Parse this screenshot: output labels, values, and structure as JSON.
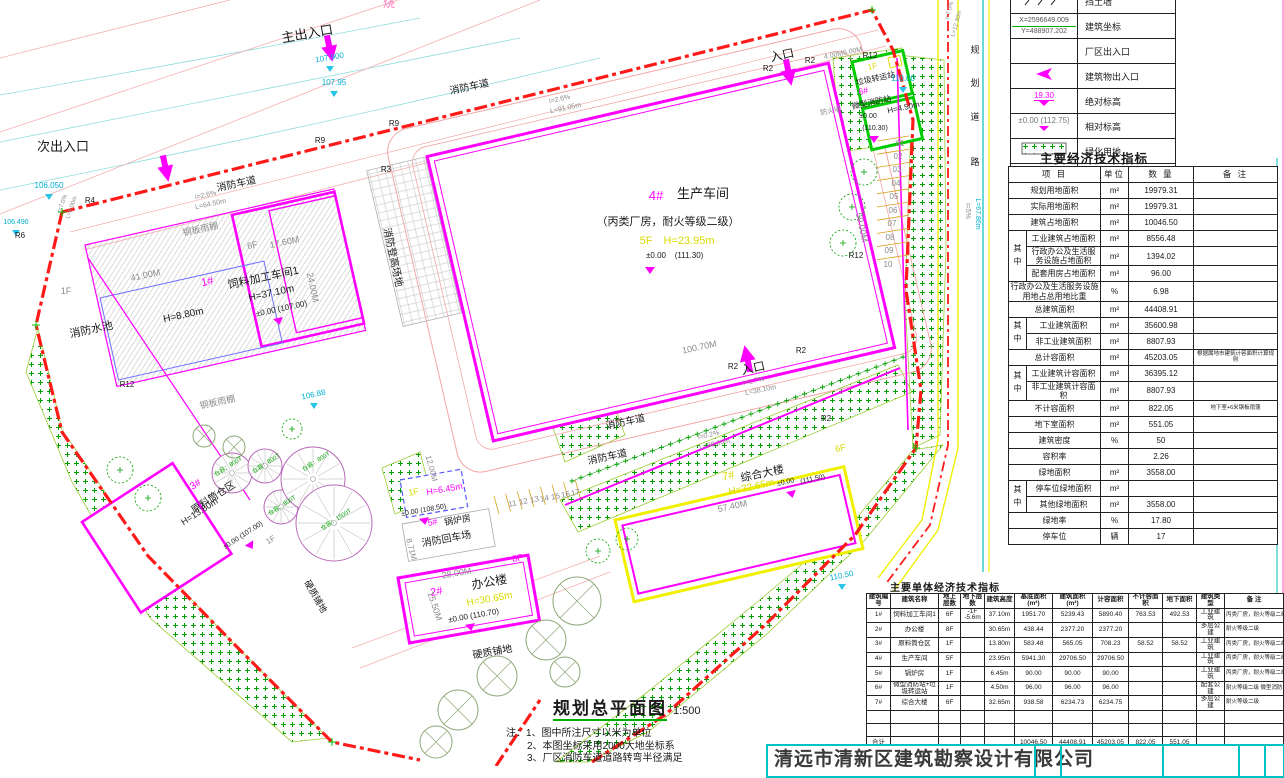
{
  "sheet": {
    "drawing_title": "规划总平面图",
    "scale": "1:500",
    "company": "清远市清新区建筑勘察设计有限公司"
  },
  "notes": {
    "prefix": "注：",
    "lines": [
      "1、图中所注尺寸以米为单位",
      "2、本图坐标采用2000大地坐标系",
      "3、厂区消防车道道路转弯半径满足"
    ]
  },
  "legend": {
    "rows": [
      {
        "sym": "retaining-wall",
        "label": "挡土墙",
        "texts": []
      },
      {
        "sym": "coords",
        "label": "建筑坐标",
        "texts": [
          "X=2596649.009",
          "Y=488907.202"
        ]
      },
      {
        "sym": "blank",
        "label": "厂区出入口",
        "texts": []
      },
      {
        "sym": "entry-arrow",
        "label": "建筑物出入口",
        "texts": []
      },
      {
        "sym": "abs-elev",
        "label": "绝对标高",
        "texts": [
          "19.30"
        ]
      },
      {
        "sym": "rel-elev",
        "label": "相对标高",
        "texts": [
          "±0.00 (112.75)"
        ]
      },
      {
        "sym": "green-hatch",
        "label": "绿化用地",
        "texts": []
      },
      {
        "sym": "road",
        "label": "厂区道路（消防车道）",
        "texts": []
      }
    ]
  },
  "tables": {
    "main": {
      "title": "主要经济技术指标",
      "headers": [
        "项  目",
        "单位",
        "数  量",
        "备  注"
      ],
      "rows": [
        {
          "item": "规划用地面积",
          "unit": "m²",
          "qty": "19979.31",
          "rem": ""
        },
        {
          "item": "实际用地面积",
          "unit": "m²",
          "qty": "19979.31",
          "rem": ""
        },
        {
          "item": "建筑占地面积",
          "unit": "m²",
          "qty": "10046.50",
          "rem": ""
        },
        {
          "g": "其中",
          "span": 3,
          "item": "工业建筑占地面积",
          "unit": "m²",
          "qty": "8556.48",
          "rem": ""
        },
        {
          "item": "行政办公及生活服务设施占地面积",
          "unit": "m²",
          "qty": "1394.02",
          "rem": ""
        },
        {
          "item": "配套用房占地面积",
          "unit": "m²",
          "qty": "96.00",
          "rem": ""
        },
        {
          "item": "行政办公及生活服务设施用地占总用地比重",
          "unit": "%",
          "qty": "6.98",
          "rem": ""
        },
        {
          "item": "总建筑面积",
          "unit": "m²",
          "qty": "44408.91",
          "rem": ""
        },
        {
          "g": "其中",
          "span": 2,
          "item": "工业建筑面积",
          "unit": "m²",
          "qty": "35600.98",
          "rem": ""
        },
        {
          "item": "非工业建筑面积",
          "unit": "m²",
          "qty": "8807.93",
          "rem": ""
        },
        {
          "item": "总计容面积",
          "unit": "m²",
          "qty": "45203.05",
          "rem": "根据属地市建筑计容面积计算规则"
        },
        {
          "g": "其中",
          "span": 2,
          "item": "工业建筑计容面积",
          "unit": "m²",
          "qty": "36395.12",
          "rem": ""
        },
        {
          "item": "非工业建筑计容面积",
          "unit": "m²",
          "qty": "8807.93",
          "rem": ""
        },
        {
          "item": "不计容面积",
          "unit": "m²",
          "qty": "822.05",
          "rem": "地下室+6米钢板雨篷"
        },
        {
          "item": "地下室面积",
          "unit": "m²",
          "qty": "551.05",
          "rem": ""
        },
        {
          "item": "建筑密度",
          "unit": "%",
          "qty": "50",
          "rem": ""
        },
        {
          "item": "容积率",
          "unit": "",
          "qty": "2.26",
          "rem": ""
        },
        {
          "item": "绿地面积",
          "unit": "m²",
          "qty": "3558.00",
          "rem": ""
        },
        {
          "g": "其中",
          "span": 2,
          "item": "停车位绿地面积",
          "unit": "m²",
          "qty": "",
          "rem": ""
        },
        {
          "item": "其他绿地面积",
          "unit": "m²",
          "qty": "3558.00",
          "rem": ""
        },
        {
          "item": "绿地率",
          "unit": "%",
          "qty": "17.80",
          "rem": ""
        },
        {
          "item": "停车位",
          "unit": "辆",
          "qty": "17",
          "rem": ""
        }
      ]
    },
    "unit": {
      "title": "主要单体经济技术指标",
      "headers": [
        "建筑编号",
        "建筑名称",
        "地上层数",
        "地下层数",
        "建筑高度",
        "基底面积(m²)",
        "建筑面积(m²)",
        "计容面积",
        "不计容面积",
        "地下面积",
        "建筑类型",
        "备  注"
      ],
      "rows": [
        [
          "1#",
          "饲料加工车间1",
          "6F",
          "-1F -5.6m",
          "37.10m",
          "1951.70",
          "5239.43",
          "5890.40",
          "763.53",
          "492.53",
          "工业建筑",
          "丙类厂房，耐火等级二级"
        ],
        [
          "2#",
          "办公楼",
          "8F",
          "",
          "30.65m",
          "438.44",
          "2377.20",
          "2377.20",
          "",
          "",
          "多层公建",
          "耐火等级二级"
        ],
        [
          "3#",
          "原料筒仓区",
          "1F",
          "",
          "13.80m",
          "583.48",
          "565.05",
          "708.23",
          "58.52",
          "58.52",
          "工业建筑",
          "丙类厂房，耐火等级二级"
        ],
        [
          "4#",
          "生产车间",
          "5F",
          "",
          "23.95m",
          "5941.30",
          "29706.50",
          "29706.50",
          "",
          "",
          "工业建筑",
          "丙类厂房，耐火等级二级"
        ],
        [
          "5#",
          "锅炉房",
          "1F",
          "",
          "6.45m",
          "90.00",
          "90.00",
          "90.00",
          "",
          "",
          "工业建筑",
          "丙类厂房，耐火等级二级"
        ],
        [
          "6#",
          "微型消防站+垃圾转运站",
          "1F",
          "",
          "4.50m",
          "96.00",
          "96.00",
          "96.00",
          "",
          "",
          "配套公建",
          "耐火等级二级 微型消防站:42.00m² 垃圾转运站:54.00m²"
        ],
        [
          "7#",
          "综合大楼",
          "6F",
          "",
          "32.65m",
          "938.58",
          "6234.73",
          "6234.75",
          "",
          "",
          "多层公建",
          "耐火等级二级"
        ],
        [
          "",
          "",
          "",
          "",
          "",
          "",
          "",
          "",
          "",
          "",
          "",
          ""
        ],
        [
          "",
          "",
          "",
          "",
          "",
          "",
          "",
          "",
          "",
          "",
          "",
          ""
        ],
        [
          "合计",
          "",
          "",
          "",
          "",
          "10046.50",
          "44408.91",
          "45203.05",
          "822.05",
          "551.05",
          "",
          ""
        ]
      ]
    }
  },
  "plan": {
    "colors": {
      "boundary_red": "#FF1A1A",
      "building_magenta": "#FF00FF",
      "greenery_green": "#00A000",
      "road_yellow": "#F0F000",
      "elevation_cyan": "#00AECF",
      "height_yellow": "#D9D900"
    },
    "labels": [
      [
        "主出入口",
        308,
        38,
        "k",
        13,
        -10
      ],
      [
        "次出入口",
        63,
        151,
        "k",
        13,
        0
      ],
      [
        "入口",
        783,
        59,
        "k",
        12,
        -12
      ],
      [
        "入口",
        754,
        372,
        "k",
        12,
        -12
      ],
      [
        "消防车道",
        237,
        187,
        "k",
        10,
        -12
      ],
      [
        "消防车道",
        470,
        90,
        "k",
        10,
        -12
      ],
      [
        "消防车道",
        626,
        425,
        "k",
        10,
        -12
      ],
      [
        "消防车道",
        608,
        460,
        "k",
        10,
        -12
      ],
      [
        "消防登高场地",
        390,
        258,
        "k",
        10,
        78
      ],
      [
        "钢板雨棚",
        201,
        232,
        "g",
        9,
        -12
      ],
      [
        "钢板雨棚",
        218,
        405,
        "g",
        9,
        -12
      ],
      [
        "消防水池",
        92,
        333,
        "k",
        11,
        -12
      ],
      [
        "H=8.80m",
        184,
        318,
        "k",
        10,
        -12
      ],
      [
        "1#",
        208,
        285,
        "m",
        11,
        -12
      ],
      [
        "饲料加工车间1",
        264,
        281,
        "k",
        11,
        -12
      ],
      [
        "H=37.10m",
        272,
        296,
        "k",
        10,
        -12
      ],
      [
        "±0.00 (107.00)",
        282,
        311,
        "k",
        8,
        -12
      ],
      [
        "1F",
        66,
        294,
        "g",
        9,
        0
      ],
      [
        "41.00M",
        146,
        278,
        "g",
        9,
        -12
      ],
      [
        "24.00M",
        310,
        288,
        "g",
        9,
        78
      ],
      [
        "6F",
        253,
        248,
        "g",
        9,
        -12
      ],
      [
        "17.60M",
        285,
        245,
        "g",
        9,
        -12
      ],
      [
        "106.88",
        314,
        397,
        "c",
        8,
        -12
      ],
      [
        "4#",
        656,
        200,
        "m",
        13,
        0
      ],
      [
        "生产车间",
        703,
        198,
        "k",
        13,
        0
      ],
      [
        "（丙类厂房，耐火等级二级）",
        668,
        225,
        "k",
        11,
        0
      ],
      [
        "5F",
        646,
        244,
        "y",
        11,
        0
      ],
      [
        "H=23.95m",
        689,
        244,
        "y",
        11,
        0
      ],
      [
        "±0.00",
        656,
        258,
        "k",
        8,
        0
      ],
      [
        "(111.30)",
        689,
        258,
        "k",
        8,
        0
      ],
      [
        "防火墙",
        831,
        113,
        "g",
        7,
        -12
      ],
      [
        "100.70M",
        700,
        350,
        "g",
        9,
        -12
      ],
      [
        "59.00M",
        859,
        228,
        "g",
        9,
        78
      ],
      [
        "R2",
        768,
        71,
        "k",
        8,
        0
      ],
      [
        "R2",
        810,
        63,
        "k",
        8,
        0
      ],
      [
        "R2",
        733,
        369,
        "k",
        8,
        0
      ],
      [
        "R2",
        801,
        353,
        "k",
        8,
        0
      ],
      [
        "R2",
        826,
        421,
        "k",
        8,
        0
      ],
      [
        "R12",
        870,
        58,
        "k",
        8,
        0
      ],
      [
        "R12",
        856,
        258,
        "k",
        8,
        0
      ],
      [
        "R12",
        127,
        387,
        "k",
        8,
        0
      ],
      [
        "R3",
        386,
        172,
        "k",
        8,
        0
      ],
      [
        "R9",
        320,
        143,
        "k",
        8,
        0
      ],
      [
        "R9",
        394,
        126,
        "k",
        8,
        0
      ],
      [
        "R4",
        90,
        203,
        "k",
        8,
        0
      ],
      [
        "R6",
        20,
        238,
        "k",
        8,
        0
      ],
      [
        "1F",
        873,
        69,
        "y",
        8,
        -12
      ],
      [
        "垃圾转运站",
        876,
        81,
        "k",
        8,
        -12
      ],
      [
        "6#",
        864,
        94,
        "m",
        9,
        -12
      ],
      [
        "微型消防站",
        872,
        105,
        "k",
        8,
        -12
      ],
      [
        "H=4.50m",
        904,
        110,
        "k",
        8,
        -12
      ],
      [
        "±0.00",
        868,
        118,
        "k",
        7,
        0
      ],
      [
        "(110.30)",
        875,
        130,
        "k",
        7,
        0
      ],
      [
        "110.00",
        903,
        81,
        "c",
        8,
        0
      ],
      [
        "01",
        900,
        146,
        "g",
        8,
        0
      ],
      [
        "02",
        898,
        159,
        "g",
        8,
        0
      ],
      [
        "03",
        897,
        172,
        "g",
        8,
        0
      ],
      [
        "04",
        896,
        186,
        "g",
        8,
        0
      ],
      [
        "05",
        894,
        199,
        "g",
        8,
        0
      ],
      [
        "06",
        893,
        213,
        "g",
        8,
        0
      ],
      [
        "07",
        892,
        226,
        "g",
        8,
        0
      ],
      [
        "08",
        890,
        240,
        "g",
        8,
        0
      ],
      [
        "09",
        889,
        253,
        "g",
        8,
        0
      ],
      [
        "10",
        888,
        267,
        "g",
        8,
        0
      ],
      [
        "11",
        513,
        506,
        "g",
        8,
        -12
      ],
      [
        "12",
        524,
        504,
        "g",
        8,
        -12
      ],
      [
        "13",
        535,
        502,
        "g",
        8,
        -12
      ],
      [
        "14",
        545,
        501,
        "g",
        8,
        -12
      ],
      [
        "15",
        556,
        499,
        "g",
        8,
        -12
      ],
      [
        "16",
        566,
        497,
        "g",
        8,
        -12
      ],
      [
        "17",
        576,
        495,
        "g",
        8,
        -12
      ],
      [
        "7#",
        729,
        479,
        "y",
        11,
        -12
      ],
      [
        "综合大楼",
        763,
        477,
        "k",
        11,
        -12
      ],
      [
        "H=32.65m",
        752,
        490,
        "y",
        10,
        -12
      ],
      [
        "±0.00",
        786,
        484,
        "k",
        7,
        -12
      ],
      [
        "(111.50)",
        813,
        481,
        "k",
        7,
        -12
      ],
      [
        "6F",
        841,
        451,
        "y",
        9,
        -12
      ],
      [
        "57.40M",
        733,
        509,
        "g",
        9,
        -12
      ],
      [
        "2#",
        437,
        595,
        "m",
        11,
        -10
      ],
      [
        "办公楼",
        490,
        586,
        "k",
        12,
        -10
      ],
      [
        "H=30.65m",
        490,
        602,
        "y",
        10,
        -10
      ],
      [
        "±0.00 (110.70)",
        474,
        618,
        "k",
        8,
        -10
      ],
      [
        "8F",
        518,
        561,
        "m",
        9,
        -10
      ],
      [
        "28.00M",
        457,
        576,
        "g",
        9,
        -10
      ],
      [
        "15.50M",
        432,
        607,
        "g",
        9,
        72
      ],
      [
        "1F",
        414,
        495,
        "y",
        9,
        -10
      ],
      [
        "H=6.45m",
        445,
        492,
        "m",
        9,
        -10
      ],
      [
        "±0.00 (108.50)",
        424,
        512,
        "k",
        7,
        -10
      ],
      [
        "5#",
        433,
        525,
        "m",
        9,
        -10
      ],
      [
        "锅炉房",
        458,
        523,
        "k",
        9,
        -10
      ],
      [
        "消防回车场",
        447,
        542,
        "k",
        10,
        -10
      ],
      [
        "3#",
        197,
        487,
        "m",
        10,
        -33
      ],
      [
        "原料筒仓区",
        215,
        500,
        "k",
        10,
        -33
      ],
      [
        "H=13.80m",
        201,
        514,
        "k",
        9,
        -33
      ],
      [
        "±0.00 (107.00)",
        244,
        537,
        "k",
        7,
        -33
      ],
      [
        "1F",
        272,
        542,
        "g",
        8,
        -33
      ],
      [
        "仓容：800T",
        229,
        468,
        "gr",
        6,
        -33
      ],
      [
        "仓容：800T",
        267,
        465,
        "gr",
        6,
        -33
      ],
      [
        "仓容：800T",
        283,
        507,
        "gr",
        6,
        -33
      ],
      [
        "仓容：800T",
        317,
        463,
        "gr",
        6,
        -33
      ],
      [
        "仓容：1500T",
        337,
        521,
        "gr",
        6,
        -33
      ],
      [
        "硬质铺地",
        493,
        655,
        "k",
        10,
        -10
      ],
      [
        "硬质铺地",
        313,
        598,
        "k",
        9,
        60
      ],
      [
        "规",
        975,
        53,
        "k",
        9,
        0
      ],
      [
        "划",
        975,
        86,
        "k",
        9,
        0
      ],
      [
        "道",
        975,
        120,
        "k",
        9,
        0
      ],
      [
        "路",
        975,
        165,
        "k",
        9,
        0
      ],
      [
        "i=5%",
        966,
        211,
        "g",
        7,
        90
      ],
      [
        "L=67.86m",
        976,
        214,
        "c",
        7,
        90
      ],
      [
        "i=7.0%",
        951,
        11,
        "g",
        6,
        -75
      ],
      [
        "L=12.30m",
        958,
        24,
        "g",
        6,
        -75
      ],
      [
        "i=2.6%",
        206,
        197,
        "g",
        7,
        -12
      ],
      [
        "L=64.50m",
        211,
        206,
        "g",
        7,
        -12
      ],
      [
        "i=2.6%",
        560,
        101,
        "g",
        7,
        -12
      ],
      [
        "L=91.05m",
        566,
        110,
        "g",
        7,
        -12
      ],
      [
        "i=1.7%",
        754,
        383,
        "g",
        7,
        -12
      ],
      [
        "L=38.10m",
        761,
        392,
        "g",
        7,
        -12
      ],
      [
        "i=0.2%",
        709,
        437,
        "g",
        7,
        -12
      ],
      [
        "L=88.00m",
        715,
        446,
        "g",
        7,
        -12
      ],
      [
        "i=7.0%",
        64,
        204,
        "g",
        6,
        -70
      ],
      [
        "L=8.00m",
        73,
        208,
        "g",
        6,
        -70
      ],
      [
        "107.900",
        330,
        60,
        "c",
        8,
        -10
      ],
      [
        "107.95",
        334,
        85,
        "c",
        8,
        0
      ],
      [
        "106.050",
        49,
        188,
        "c",
        8,
        0
      ],
      [
        "106.490",
        16,
        224,
        "c",
        7,
        0
      ],
      [
        "110.50",
        842,
        578,
        "c",
        8,
        -12
      ],
      [
        "4.00M",
        834,
        57,
        "g",
        7,
        -12
      ],
      [
        "6.00M",
        853,
        53,
        "g",
        7,
        -12
      ],
      [
        "12.00M",
        429,
        469,
        "g",
        8,
        75
      ],
      [
        "8.71M",
        409,
        550,
        "g",
        8,
        75
      ],
      [
        "烧",
        389,
        7,
        "pk",
        12,
        0
      ]
    ]
  }
}
